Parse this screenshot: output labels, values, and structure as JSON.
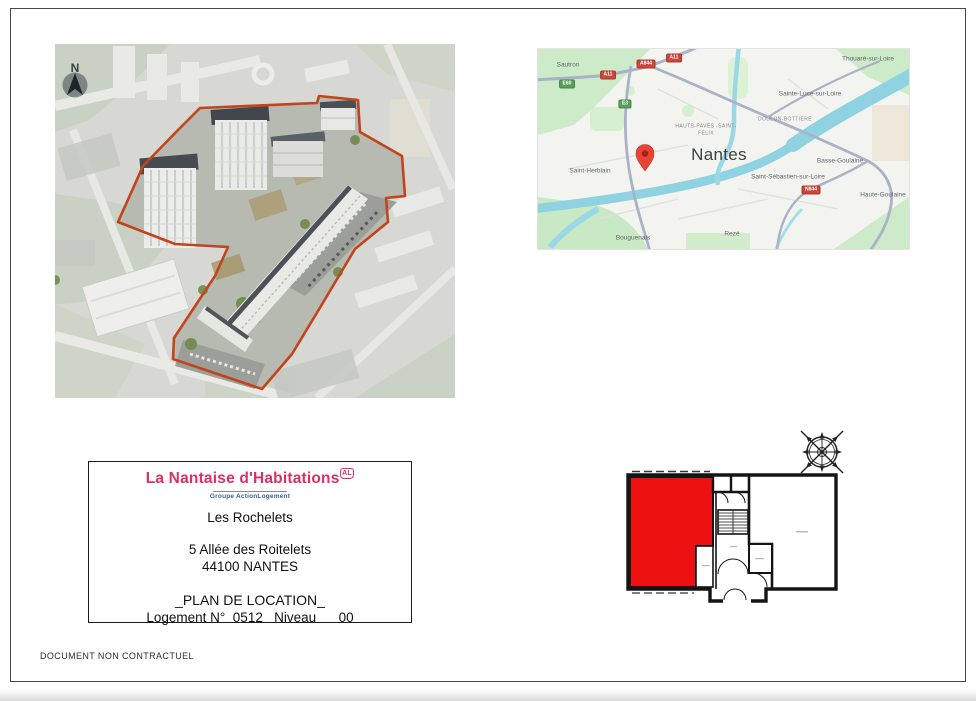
{
  "page": {
    "footer_note": "DOCUMENT NON CONTRACTUEL"
  },
  "aerial": {
    "north_label": "N"
  },
  "map": {
    "city": "Nantes",
    "towns": [
      "Sautron",
      "Saint-Herblain",
      "Bouguenais",
      "Rezé",
      "Thouaré-sur-Loire",
      "Sainte-Luce-sur-Loire",
      "Basse-Goulaine",
      "Saint-Sébastien-sur-Loire",
      "Haute-Goulaine"
    ],
    "districts": [
      "HAUTS-PAVÉS -SAINT-FÉLIX",
      "DOULON-BOTTIÈRE"
    ],
    "badges": [
      {
        "label": "A11",
        "type": "red"
      },
      {
        "label": "A844",
        "type": "red"
      },
      {
        "label": "A11",
        "type": "red"
      },
      {
        "label": "E60",
        "type": "green"
      },
      {
        "label": "E3",
        "type": "green"
      },
      {
        "label": "N844",
        "type": "red"
      }
    ]
  },
  "info_box": {
    "org_name": "La Nantaise d'Habitations",
    "org_logo": "AL",
    "org_group": "Groupe ActionLogement",
    "residence": "Les Rochelets",
    "address_line1": "5 Allée des Roitelets",
    "address_line2": "44100 NANTES",
    "plan_title": "_PLAN DE LOCATION_",
    "unit_line": "Logement N°  0512   Niveau      00"
  },
  "colors": {
    "brand_pink": "#dd2f63",
    "brand_blue": "#3d5a96",
    "highlight_red": "#ed1111",
    "outline_orange": "#c2441c",
    "water": "#8fd2e2"
  }
}
